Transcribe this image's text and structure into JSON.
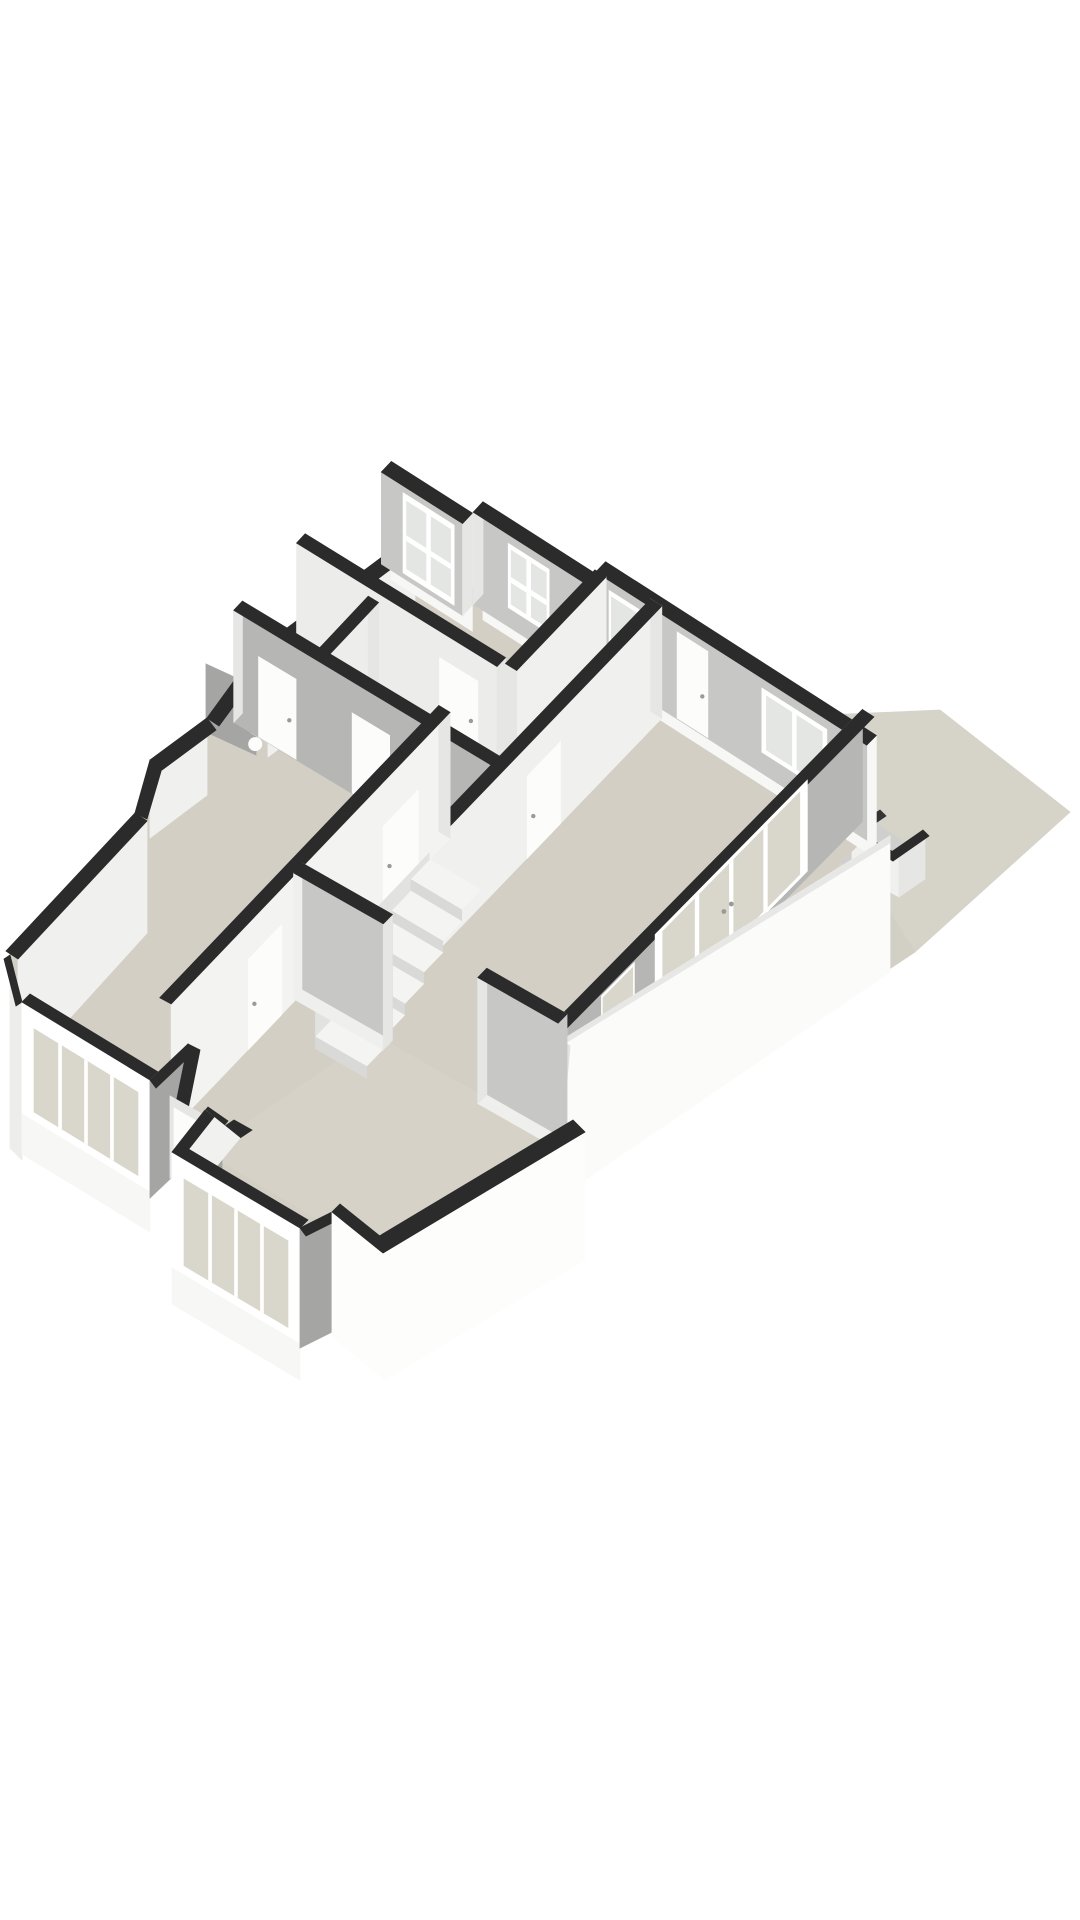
{
  "meta": {
    "title": "3D floor plan perspective render",
    "type": "isometric-floorplan",
    "floor_shown": "single storey cutaway"
  },
  "canvas": {
    "width": 1080,
    "height": 1920,
    "background": "#ffffff"
  },
  "colors": {
    "bg": "#ffffff",
    "cap": "#2b2b2b",
    "capSoft": "#343434",
    "terrace": "#d6d3c9",
    "terracePath": "#d2cfc5",
    "floor": "#d3cfc4",
    "floorFront": "#d6d2c7",
    "extLit": "#f7f7f6",
    "extWhite": "#fdfdfc",
    "extShade": "#a5a5a4",
    "intShadow": "#b6b6b5",
    "intGray": "#c7c7c6",
    "intLit": "#f0f0ef",
    "endFace": "#e6e6e5",
    "frame": "#ffffff",
    "frameShade": "#dededd",
    "glass": "#e3e6e3",
    "glassWarm": "#d9d6cb",
    "stepTop": "#f4f4f3",
    "stepFace": "#d9d9d8",
    "boundary": "#fbfbfa",
    "boundaryEdge": "#e7e7e6",
    "doorWhite": "#fcfcfb",
    "handle": "#9a9a9a",
    "wellSide": "#e2e2e1"
  },
  "scene": {
    "terrace": {
      "name": "terrace-garden",
      "back_steps": 5,
      "side_steps": 4
    },
    "basement_enclosure": {
      "name": "basement-stair-enclosure"
    },
    "rooms": [
      {
        "name": "back-bedroom",
        "windows": 2
      },
      {
        "name": "rear-vestibule",
        "back_door": 1
      },
      {
        "name": "hallway",
        "doors": 2
      },
      {
        "name": "wc",
        "fixtures": 1
      },
      {
        "name": "left-bedroom",
        "bay_panes": 4
      },
      {
        "name": "living-room",
        "glass_door_panes": 4
      },
      {
        "name": "front-room",
        "bay_panes": 4
      }
    ],
    "interior_staircase_steps": 6,
    "front_door": {
      "name": "porch-front-door"
    }
  }
}
